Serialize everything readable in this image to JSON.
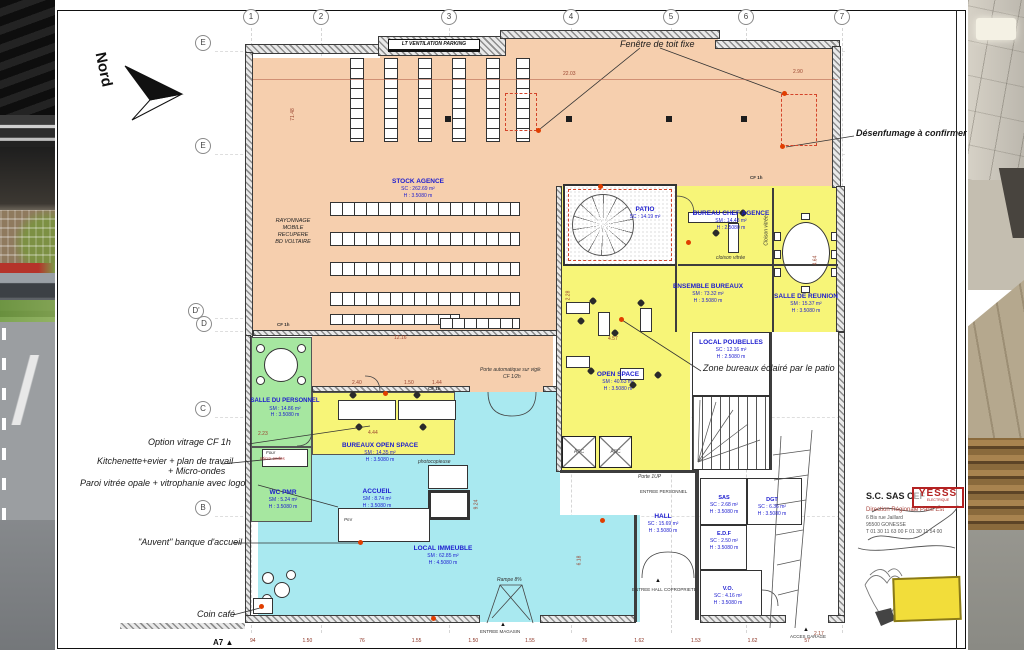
{
  "sheet": {
    "ref": "A7",
    "compass": "Nord"
  },
  "grid": {
    "top": [
      "1",
      "2",
      "3",
      "4",
      "5",
      "6",
      "7"
    ],
    "left": [
      "E",
      "E",
      "D'",
      "D",
      "C",
      "B"
    ]
  },
  "ventilation_box": "LT VENTILATION PARKING",
  "rooms": {
    "stock": {
      "name": "STOCK AGENCE",
      "area": "SC : 262.69 m²",
      "height": "H : 3.5080 m"
    },
    "rayonnage": {
      "l1": "RAYONNAGE",
      "l2": "MOBILE",
      "l3": "RECUPERE",
      "l4": "BD VOLTAIRE"
    },
    "patio": {
      "name": "PATIO",
      "area": "SC : 14.19 m²"
    },
    "chef": {
      "name": "BUREAU CHEF AGENCE",
      "area": "SM : 14.48 m²",
      "height": "H : 2.5080 m"
    },
    "ensemble": {
      "name": "ENSEMBLE BUREAUX",
      "area": "SM : 73.32 m²",
      "height": "H : 3.5080 m"
    },
    "reunion": {
      "name": "SALLE DE REUNION",
      "area": "SM : 15.37 m²",
      "height": "H : 3.5080 m"
    },
    "poubelles": {
      "name": "LOCAL POUBELLES",
      "area": "SC : 12.16 m²",
      "height": "H : 2.5080 m"
    },
    "openspace": {
      "name": "OPEN SPACE",
      "area": "SM : 40.63 m²",
      "height": "H : 3.5080 m"
    },
    "personnel": {
      "name": "SALLE DU PERSONNEL",
      "area": "SM : 14.86 m²",
      "height": "H : 3.5080 m"
    },
    "wcpmr": {
      "name": "WC PMR",
      "area": "SM : 5.24 m²",
      "height": "H : 3.5080 m"
    },
    "bureaux_os": {
      "name": "BUREAUX OPEN SPACE",
      "area": "SM : 14.35 m²",
      "height": "H : 3.5080 m"
    },
    "accueil": {
      "name": "ACCUEIL",
      "area": "SM : 8.74 m²",
      "height": "H : 3.5080 m"
    },
    "immeuble": {
      "name": "LOCAL IMMEUBLE",
      "area": "SM : 62.85 m²",
      "height": "H : 4.5080 m"
    },
    "hall": {
      "name": "HALL",
      "area": "SC : 15.69 m²",
      "height": "H : 3.5080 m"
    },
    "sas": {
      "name": "SAS",
      "area": "SC : 2.68 m²",
      "height": "H : 3.5080 m"
    },
    "dgt": {
      "name": "DGT",
      "area": "SC : 6.36 m²",
      "height": "H : 3.5080 m"
    },
    "edf": {
      "name": "E.D.F",
      "area": "SC : 2.50 m²",
      "height": "H : 3.5080 m"
    },
    "vo": {
      "name": "V.O.",
      "area": "SC : 4.16 m²",
      "height": "H : 3.5080 m"
    },
    "asc1": "ASC",
    "asc2": "ASC"
  },
  "annotations": {
    "fenetre_toit": "Fenêtre de toit fixe",
    "desenfumage": "Désenfumage à confirmer",
    "zone_bureaux": "Zone bureaux éclairé par le patio",
    "option_vitrage": "Option vitrage CF 1h",
    "kitchenette": "Kitchenette+evier + plan de travail",
    "kitchenette2": "+ Micro-ondes",
    "paroi": "Paroi vitrée opale + vitrophanie avec logo",
    "auvent": "\"Auvent\" banque d'accueil",
    "coin_cafe": "Coin café",
    "porte_auto": "Porte automatique sur vigik",
    "porte_auto2": "CF 1/2h",
    "photocopieuse": "photocopieuse",
    "cloison_vitree": "cloison vitrée",
    "cloison_vitree_v": "Cloison vitrée",
    "rampe": "Rampe 8%",
    "porte_1up": "Porte 1UP",
    "entree_personnel": "ENTREE PERSONNEL",
    "entree_hall": "ENTREE HALL COPROPRIETE",
    "entree_magasin": "ENTREE MAGASIN",
    "acces_garage": "ACCES GARAGE",
    "cf1h_a": "CF 1h",
    "cf1h_b": "CF 1h",
    "cf1h_c": "CF 1h",
    "four": "Four",
    "micro_ondes": "Micro-ondes",
    "pmr": "Pmr"
  },
  "dims": {
    "d_2203": "22.03",
    "d_7148": "71.48",
    "d_1216": "12.16",
    "d_240": "2.40",
    "d_150": "1.50",
    "d_144": "1.44",
    "d_457": "4.57",
    "d_444": "4.44",
    "d_924": "9.24",
    "d_618": "6.18",
    "d_217": "2.17",
    "d_290": "2.90",
    "d_464": "4.64",
    "d_228": "2.28",
    "d_223": "2.23",
    "bottom": [
      "94",
      "1.50",
      "76",
      "1.55",
      "1.50",
      "1.55",
      "76",
      "1.62",
      "1.53",
      "1.62",
      "57"
    ]
  },
  "titleblock": {
    "company": "S.C. SAS CEF",
    "stamp": "YESSS",
    "stamp_sub": "ELECTRIQUE",
    "line1": "Direction Régionale Paris Est",
    "line2": "6 Bis rue Jaillard",
    "line3": "95500 GONESSE",
    "line4": "T 01 30 11 63 00  F 01 30 11 54 00"
  },
  "colors": {
    "zone_stock": "#f6cfae",
    "zone_offices": "#f7f578",
    "zone_social": "#a6e7a0",
    "zone_public": "#a9e9f0",
    "label_blue": "#1c1ccf",
    "marker_red": "#e03e00"
  }
}
